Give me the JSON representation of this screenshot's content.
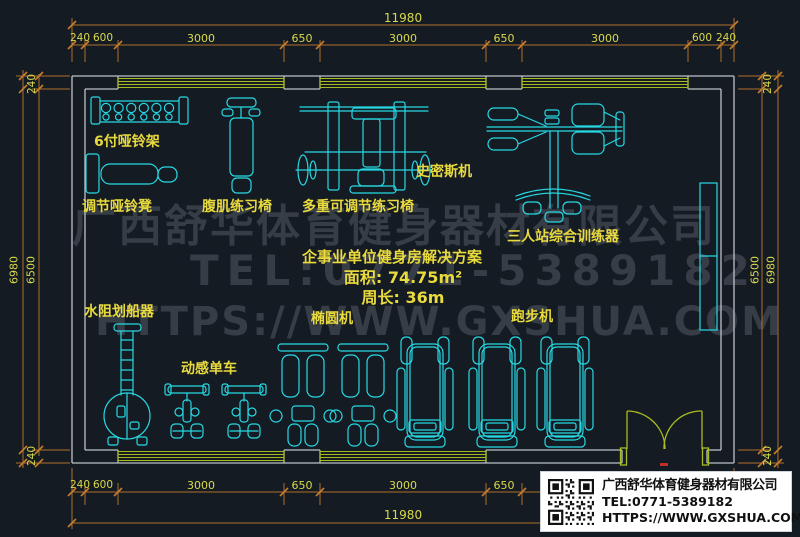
{
  "watermark": {
    "line1": "广西舒华体育健身器材有限公司",
    "line2": "TEL:0771-5389182",
    "line3": "HTTPS://WWW.GXSHUA.COM"
  },
  "info": {
    "title": "企事业单位健身房解决方案",
    "area": "面积: 74.75m²",
    "perimeter": "周长: 36m"
  },
  "equipment_labels": {
    "dumbbell_rack": "6付哑铃架",
    "adjustable_dumbbell_bench": "调节哑铃凳",
    "ab_bench": "腹肌练习椅",
    "multi_adjustable_bench": "多重可调节练习椅",
    "smith_machine": "史密斯机",
    "three_station_trainer": "三人站综合训练器",
    "rowing_machine": "水阻划船器",
    "spin_bike": "动感单车",
    "elliptical": "椭圆机",
    "treadmill": "跑步机"
  },
  "dimensions": {
    "top_total": "11980",
    "bottom_total": "11980",
    "h_segments": [
      "240",
      "600",
      "3000",
      "650",
      "3000",
      "650",
      "3000",
      "600",
      "240"
    ],
    "left": {
      "outer": "6980",
      "inner": "6500",
      "top": "240",
      "bottom": "240"
    },
    "right": {
      "inner": "6500",
      "outer": "6980",
      "top": "240",
      "bottom": "240"
    }
  },
  "title_block": {
    "company": "广西舒华体育健身器材有限公司",
    "tel": "TEL:0771-5389182",
    "url": "HTTPS://WWW.GXSHUA.COM"
  },
  "colors": {
    "background": "#151b23",
    "equipment": "#27d9e4",
    "walls": "#bcc2c6",
    "windows_door": "#a8bc20",
    "dimension_lines": "#b06e29",
    "dimension_text": "#d8da4a",
    "labels": "#e9da3d",
    "watermark": "#363d46"
  }
}
